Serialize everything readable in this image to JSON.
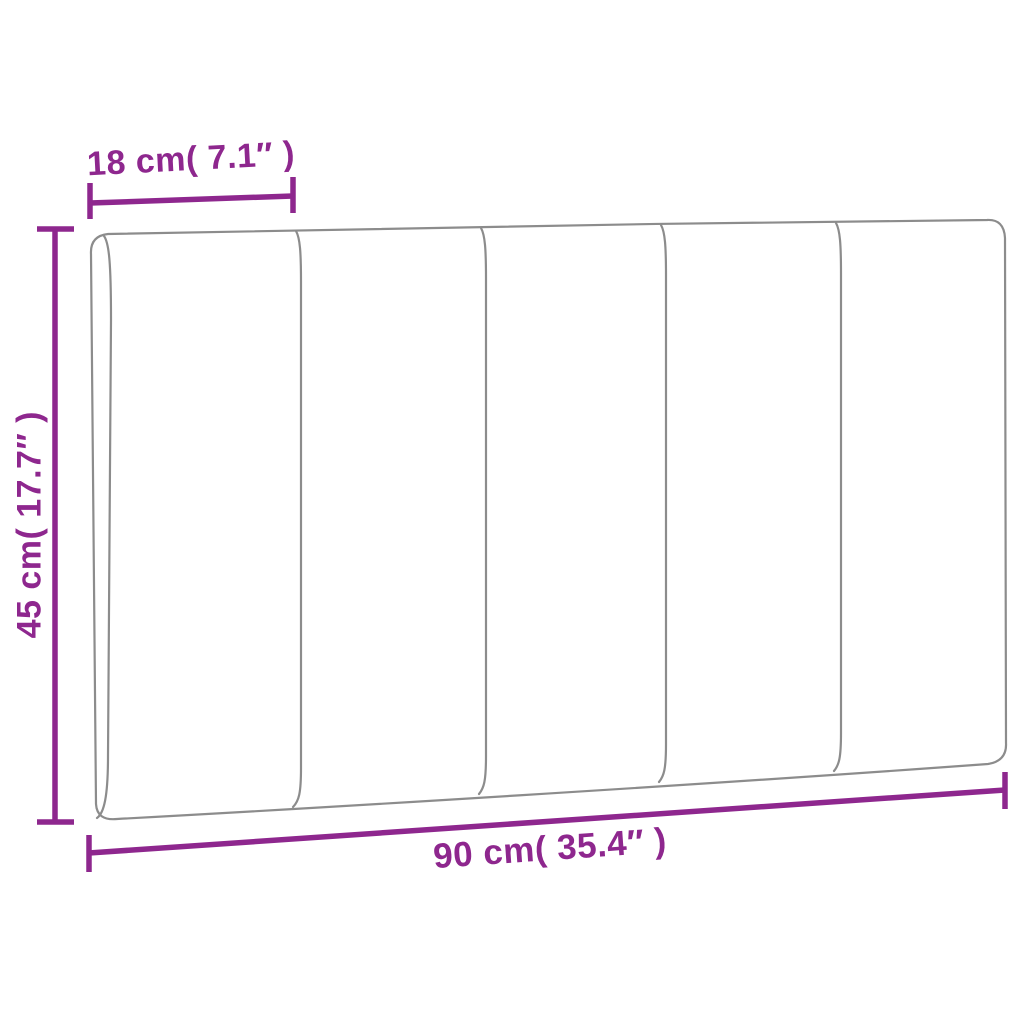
{
  "diagram": {
    "subject": "headboard-cushion-dimension-diagram",
    "panel_count": 5,
    "colors": {
      "dimension": "#8e278e",
      "outline": "#8c8c8c",
      "background": "#ffffff"
    },
    "dimensions": {
      "top": {
        "label": "18 cm( 7.1″ )",
        "cm": "18",
        "inches": "7.1"
      },
      "left": {
        "label": "45 cm( 17.7″ )",
        "cm": "45",
        "inches": "17.7"
      },
      "bottom": {
        "label": "90 cm( 35.4″ )",
        "cm": "90",
        "inches": "35.4"
      }
    }
  }
}
